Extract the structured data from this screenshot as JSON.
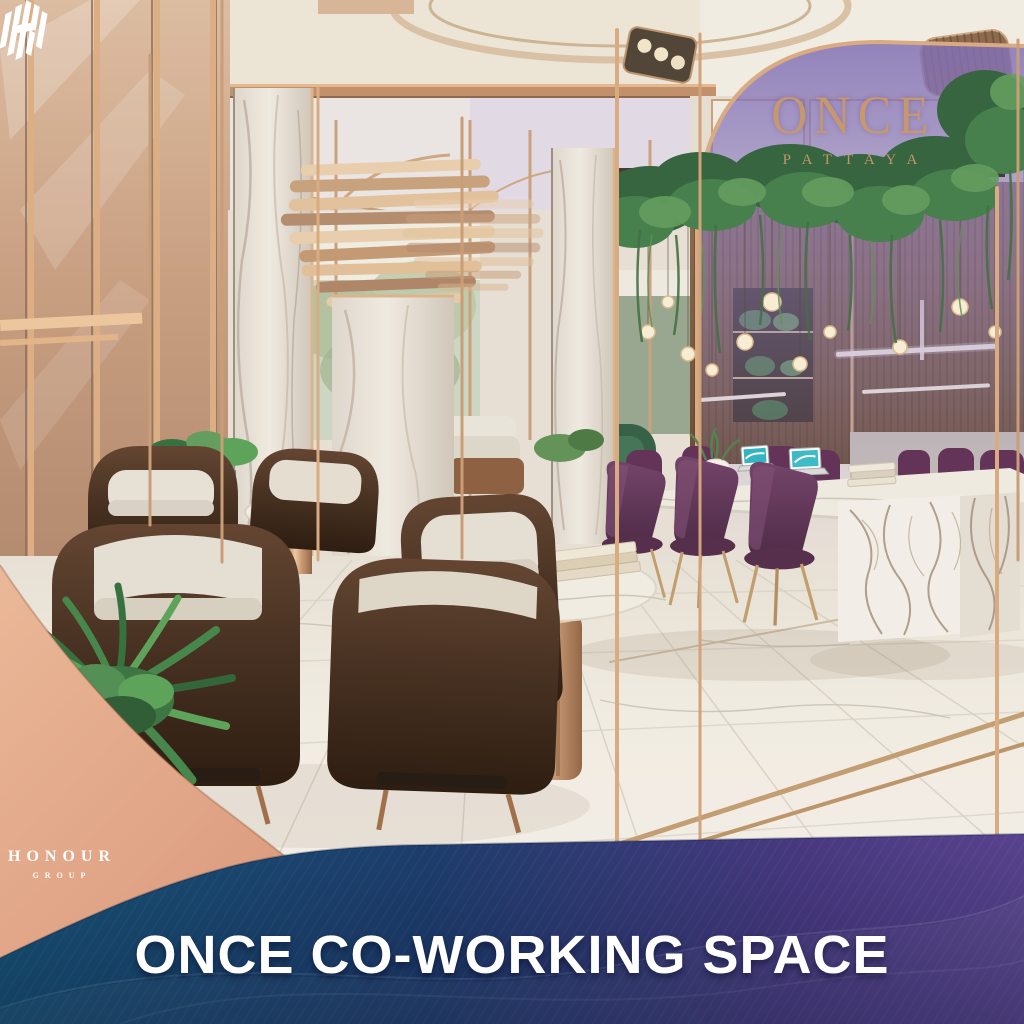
{
  "page": {
    "kind": "real-estate marketing image",
    "width": 1024,
    "height": 1024
  },
  "brand": {
    "once": {
      "title": "ONCE",
      "subtitle": "PATTAYA",
      "color": "#c9996c"
    },
    "honour": {
      "title": "HONOUR",
      "subtitle": "GROUP",
      "color": "#ffffff",
      "panel_color": "#dfa184"
    }
  },
  "banner": {
    "title": "ONCE CO-WORKING SPACE",
    "text_color": "#ffffff",
    "gradient_left": "#175577",
    "gradient_mid": "#1e3f6e",
    "gradient_right": "#5a4490"
  },
  "scene": {
    "subject": "luxury co-working lounge interior rendering",
    "palette": {
      "marble": "#efe9e0",
      "rose_gold": "#c9996e",
      "bronze_slats": "#7a5a42",
      "chair_brown": "#3e2718",
      "cushion_cream": "#e7e0d3",
      "chair_purple": "#5c2b52",
      "plant_green": "#3f7a46",
      "arch_glass_purple": "#8c7ac0"
    }
  }
}
